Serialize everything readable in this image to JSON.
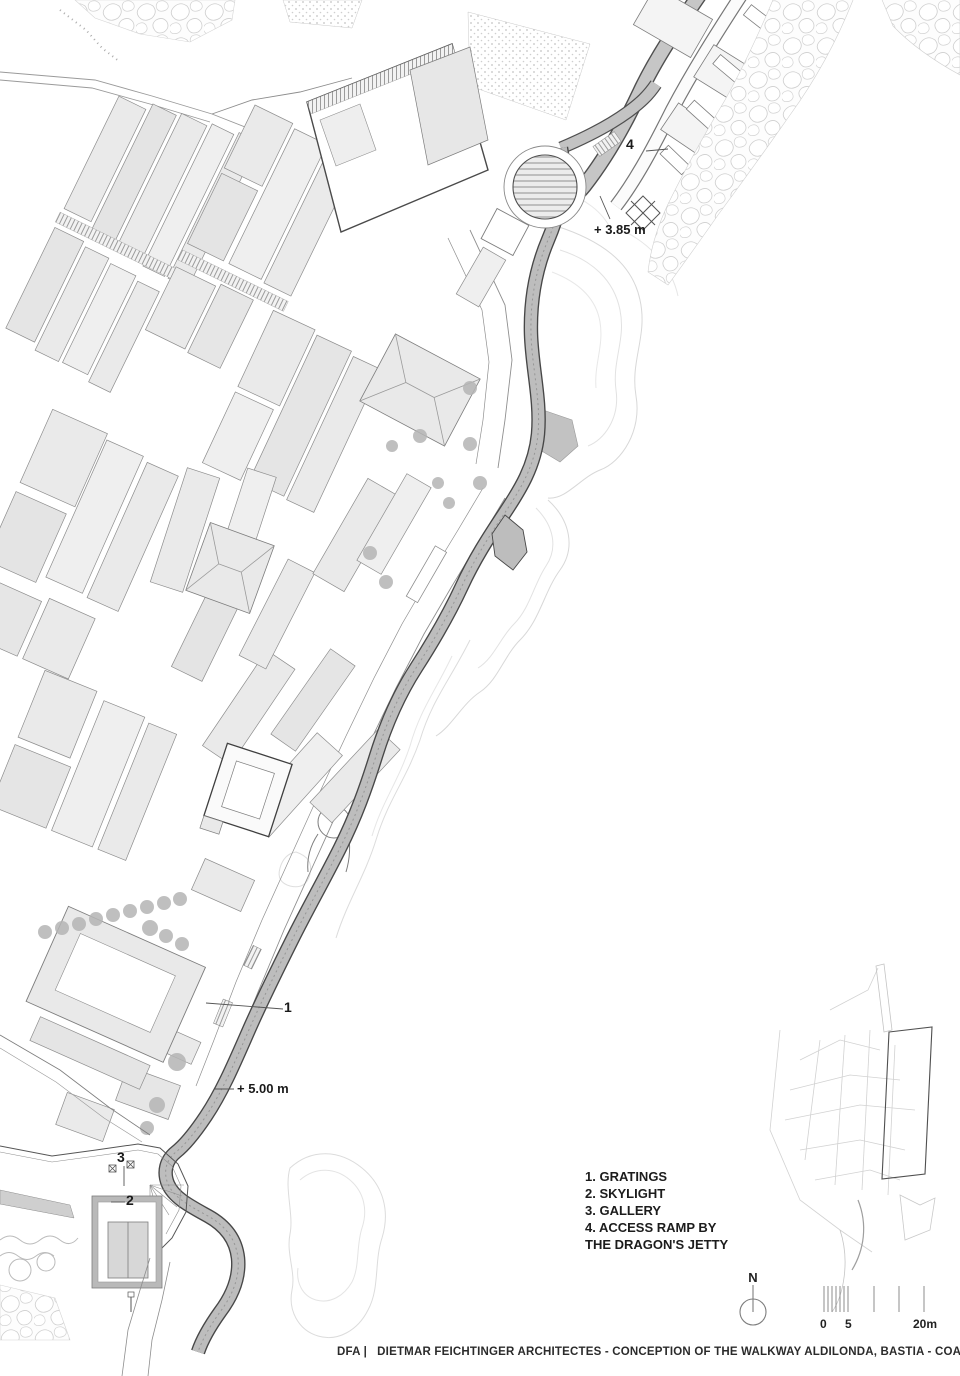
{
  "sheet": {
    "footer": "DFA |   DIETMAR FEICHTINGER ARCHITECTES - CONCEPTION OF THE WALKWAY ALDILONDA, BASTIA - COASTLINE PATH"
  },
  "legend": {
    "items": [
      "1. GRATINGS",
      "2. SKYLIGHT",
      "3. GALLERY",
      "4. ACCESS RAMP BY THE DRAGON'S JETTY"
    ]
  },
  "annotations": {
    "marker_1": "1",
    "marker_2": "2",
    "marker_3": "3",
    "marker_4": "4",
    "elevation_jetty": "+ 3.85 m",
    "elevation_walkway": "+ 5.00 m"
  },
  "compass": {
    "north_label": "N"
  },
  "scale_bar": {
    "labels": [
      "0",
      "5",
      "20m"
    ]
  },
  "colors": {
    "paper": "#ffffff",
    "ink": "#1a1a1a",
    "building_fill": "#eaeaea",
    "walkway_gray": "#bcbcbc",
    "line_gray": "#8d8d8d",
    "contour_gray": "#d8d8d8"
  }
}
